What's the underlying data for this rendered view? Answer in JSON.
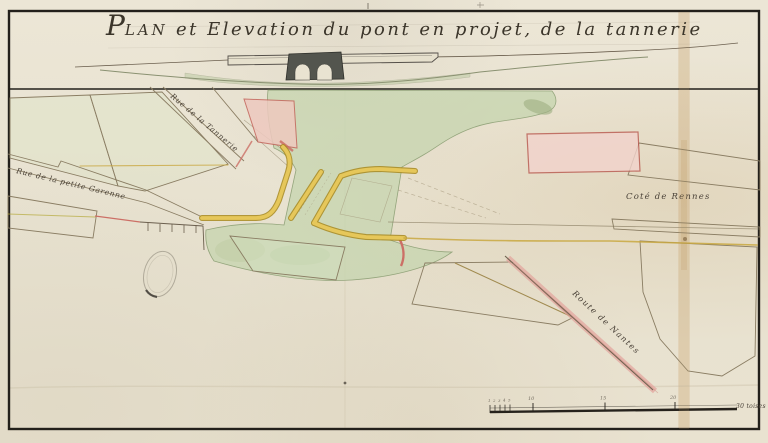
{
  "title": {
    "initial": "P",
    "small_caps": "LAN",
    "rest": " et Elevation du pont en projet, de la tannerie"
  },
  "plan_labels": {
    "rue_de_la_tannerie": "Rue de la Tannerie",
    "rue_de_la_petite_garenne": "Rue de la petite Garenne",
    "cote_de_rennes": "Coté de Rennes",
    "route_de_nantes": "Route de Nantes"
  },
  "scale_bar": {
    "minor_tick_labels": [
      "1",
      "2",
      "3",
      "4",
      "5"
    ],
    "major_tick_labels": [
      "10",
      "15",
      "20"
    ],
    "unit_label": "30 toises"
  },
  "features": {
    "bridge_arch_count": 2,
    "seal": "embossed-oval-seal"
  },
  "colors": {
    "paper": "#e8e2d0",
    "ink": "#4a4238",
    "frame": "#23201b",
    "water_green": "#c6d5b0",
    "hatch_green": "#9cb47c",
    "quay_yellow": "#dcbb4a",
    "road_pink": "#e2a29b",
    "plot_pink": "#f2d3cc",
    "bridge_masonry": "#53554e"
  }
}
